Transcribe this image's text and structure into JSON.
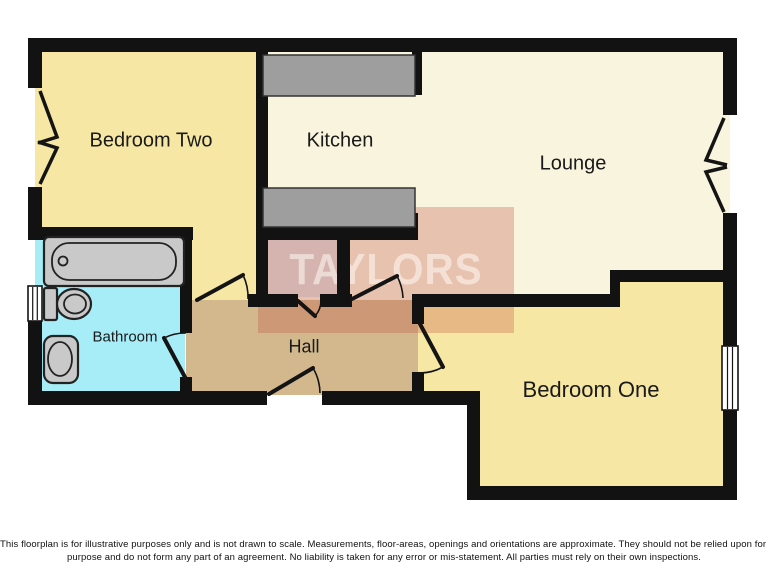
{
  "floorplan": {
    "watermark_text": "TAYLORS",
    "rooms": {
      "bedroom_two": {
        "label": "Bedroom Two"
      },
      "kitchen": {
        "label": "Kitchen"
      },
      "lounge": {
        "label": "Lounge"
      },
      "bathroom": {
        "label": "Bathroom"
      },
      "hall": {
        "label": "Hall"
      },
      "bedroom_one": {
        "label": "Bedroom One"
      }
    },
    "colors": {
      "wall": "#121212",
      "bedroom": "#F6E7A4",
      "living": "#F8F4DE",
      "bathroom": "#A6EDF8",
      "hall": "#D3B88E",
      "cupboard": "#DEDEDE",
      "counter": "#9E9E9E",
      "fixture": "#C9C9C9",
      "watermark_band": "rgba(193,80,62,0.30)",
      "watermark_text": "rgba(255,250,245,0.55)"
    }
  },
  "disclaimer": {
    "line1": "This floorplan is for illustrative purposes only and is not drawn to scale. Measurements, floor-areas, openings and orientations are approximate. They should not be relied upon for any",
    "line2": "purpose and do not form any part of an agreement. No liability is taken for any error or mis-statement. All parties must rely on their own inspections."
  }
}
